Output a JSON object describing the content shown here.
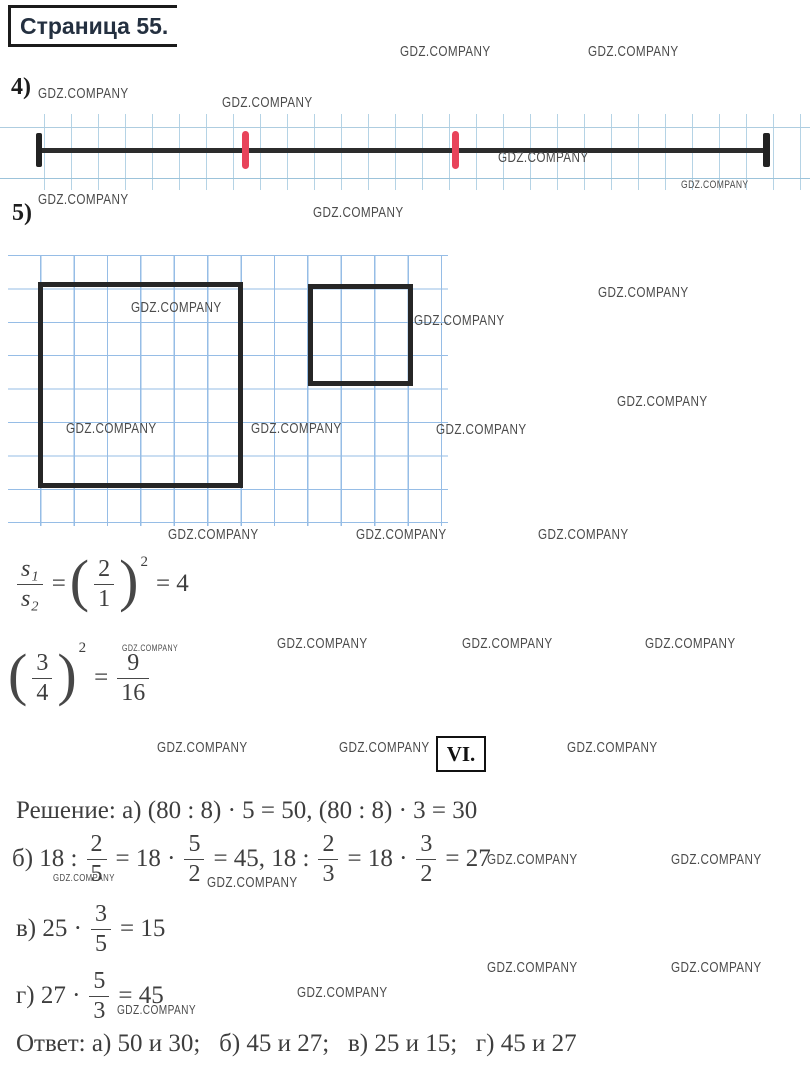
{
  "title": "Страница 55.",
  "watermark": "GDZ.COMPANY",
  "labels": {
    "p4": "4)",
    "p5": "5)",
    "section": "VI."
  },
  "watermarks": [
    {
      "x": 400,
      "y": 44,
      "s": 15
    },
    {
      "x": 588,
      "y": 44,
      "s": 15
    },
    {
      "x": 38,
      "y": 86,
      "s": 15
    },
    {
      "x": 222,
      "y": 95,
      "s": 15
    },
    {
      "x": 498,
      "y": 150,
      "s": 15
    },
    {
      "x": 681,
      "y": 180,
      "s": 11
    },
    {
      "x": 38,
      "y": 192,
      "s": 15
    },
    {
      "x": 313,
      "y": 205,
      "s": 15
    },
    {
      "x": 131,
      "y": 300,
      "s": 15
    },
    {
      "x": 414,
      "y": 313,
      "s": 15
    },
    {
      "x": 598,
      "y": 285,
      "s": 15
    },
    {
      "x": 617,
      "y": 394,
      "s": 15
    },
    {
      "x": 66,
      "y": 421,
      "s": 15
    },
    {
      "x": 251,
      "y": 421,
      "s": 15
    },
    {
      "x": 436,
      "y": 422,
      "s": 15
    },
    {
      "x": 168,
      "y": 527,
      "s": 15
    },
    {
      "x": 356,
      "y": 527,
      "s": 15
    },
    {
      "x": 538,
      "y": 527,
      "s": 15
    },
    {
      "x": 277,
      "y": 636,
      "s": 15
    },
    {
      "x": 462,
      "y": 636,
      "s": 15
    },
    {
      "x": 645,
      "y": 636,
      "s": 15
    },
    {
      "x": 122,
      "y": 644,
      "s": 9
    },
    {
      "x": 157,
      "y": 740,
      "s": 15
    },
    {
      "x": 339,
      "y": 740,
      "s": 15
    },
    {
      "x": 567,
      "y": 740,
      "s": 15
    },
    {
      "x": 487,
      "y": 852,
      "s": 15
    },
    {
      "x": 671,
      "y": 852,
      "s": 15
    },
    {
      "x": 53,
      "y": 874,
      "s": 10
    },
    {
      "x": 207,
      "y": 875,
      "s": 15
    },
    {
      "x": 487,
      "y": 960,
      "s": 15
    },
    {
      "x": 671,
      "y": 960,
      "s": 15
    },
    {
      "x": 297,
      "y": 985,
      "s": 15
    },
    {
      "x": 117,
      "y": 1003,
      "s": 13
    }
  ],
  "math": {
    "f1": [
      {
        "t": "frac",
        "n": "s₁",
        "d": "s₂",
        "it": true
      },
      {
        "t": "txt",
        "v": "="
      },
      {
        "t": "lp"
      },
      {
        "t": "frac",
        "n": "2",
        "d": "1"
      },
      {
        "t": "rp"
      },
      {
        "t": "sup",
        "v": "2"
      },
      {
        "t": "txt",
        "v": "= 4"
      }
    ],
    "f2": [
      {
        "t": "lp"
      },
      {
        "t": "frac",
        "n": "3",
        "d": "4"
      },
      {
        "t": "rp"
      },
      {
        "t": "sup",
        "v": "2"
      },
      {
        "t": "txt",
        "v": "="
      },
      {
        "t": "frac",
        "n": "9",
        "d": "16"
      }
    ],
    "solution": [
      {
        "t": "txt",
        "v": "Решение: а) (80 : 8) · 5 = 50, (80 : 8) · 3 = 30"
      }
    ],
    "b": [
      {
        "t": "txt",
        "v": "б) 18 :"
      },
      {
        "t": "frac",
        "n": "2",
        "d": "5"
      },
      {
        "t": "txt",
        "v": "= 18 ·"
      },
      {
        "t": "frac",
        "n": "5",
        "d": "2"
      },
      {
        "t": "txt",
        "v": "= 45, 18 :"
      },
      {
        "t": "frac",
        "n": "2",
        "d": "3"
      },
      {
        "t": "txt",
        "v": "= 18 ·"
      },
      {
        "t": "frac",
        "n": "3",
        "d": "2"
      },
      {
        "t": "txt",
        "v": "= 27"
      }
    ],
    "v": [
      {
        "t": "txt",
        "v": "в) 25 ·"
      },
      {
        "t": "frac",
        "n": "3",
        "d": "5"
      },
      {
        "t": "txt",
        "v": "= 15"
      }
    ],
    "g": [
      {
        "t": "txt",
        "v": "г) 27 ·"
      },
      {
        "t": "frac",
        "n": "5",
        "d": "3"
      },
      {
        "t": "txt",
        "v": "= 45"
      }
    ],
    "answer": [
      {
        "t": "txt",
        "v": "Ответ: а) 50 и 30;  б) 45 и 27;  в) 25 и 15;  г) 45 и 27"
      }
    ]
  },
  "figure4": {
    "line_color": "#2c2c2c",
    "red_tick_color": "#e8435a",
    "grid_color": "#b5d3e5"
  },
  "figure5": {
    "grid_color": "#96bde6",
    "square_color": "#262626"
  }
}
